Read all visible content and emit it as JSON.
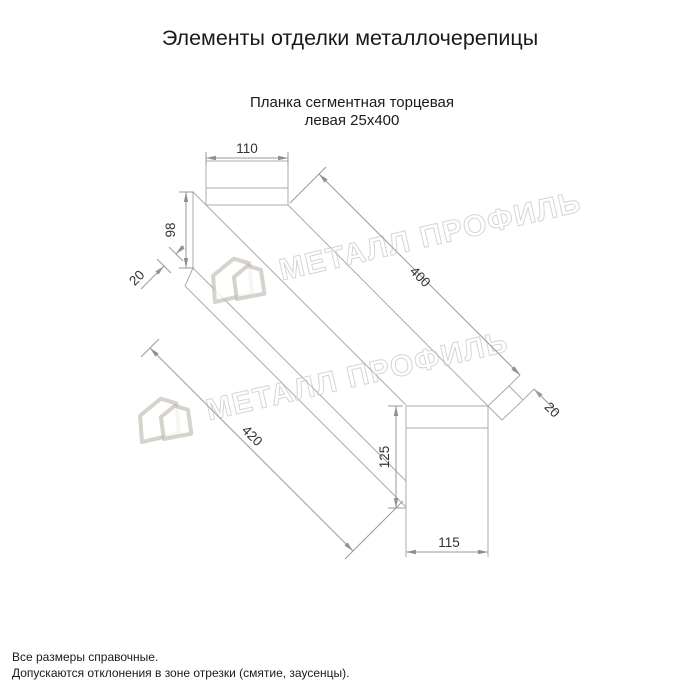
{
  "title": "Элементы отделки металлочерепицы",
  "drawing": {
    "subtitle_line1": "Планка сегментная торцевая",
    "subtitle_line2": "левая 25х400",
    "dimensions": {
      "top_width": "110",
      "web_height": "98",
      "left_hem": "20",
      "face_length": "400",
      "right_hem": "20",
      "bottom_length": "420",
      "right_height": "125",
      "right_width": "115"
    }
  },
  "watermark": {
    "text": "МЕТАЛЛ ПРОФИЛЬ"
  },
  "footer": {
    "line1": "Все размеры справочные.",
    "line2": "Допускаются отклонения в зоне отрезки (смятие, заусенцы)."
  },
  "colors": {
    "background": "#ffffff",
    "outline_line": "#ababab",
    "dimension_line": "#9a9a9a",
    "dimension_text": "#333333",
    "heading_text": "#1a1a1a",
    "watermark": "#bab5ad"
  }
}
